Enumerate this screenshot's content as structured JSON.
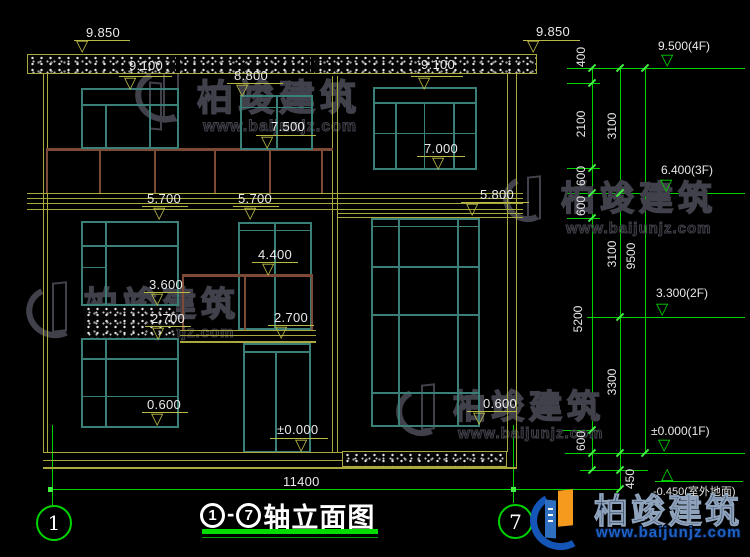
{
  "title": {
    "start": "1",
    "dash": "-",
    "end": "7",
    "text": "轴立面图"
  },
  "axes": {
    "left": "1",
    "right": "7"
  },
  "levels": {
    "a9850_l": "9.850",
    "a9850_r": "9.850",
    "a9100_l": "9.100",
    "a9100_r": "9.100",
    "a8800": "8.800",
    "a7500": "7.500",
    "a7000": "7.000",
    "a5700_l": "5.700",
    "a5700_r": "5.700",
    "a5800": "5.800",
    "a4400": "4.400",
    "a3600": "3.600",
    "a2700_l": "2.700",
    "a2700_r": "2.700",
    "a0600_l": "0.600",
    "a0600_r": "0.600",
    "a0000": "±0.000"
  },
  "floors": {
    "f4": "9.500(4F)",
    "f3": "6.400(3F)",
    "f2": "3.300(2F)",
    "f1": "±0.000(1F)",
    "outdoor": "-0.450(室外地面)"
  },
  "vdims": {
    "seg400": "400",
    "seg2100": "2100",
    "seg600a": "600",
    "seg600b": "600",
    "seg5200": "5200",
    "seg600c": "600",
    "seg450": "450",
    "seg3100a": "3100",
    "seg3100b": "3100",
    "seg3300": "3300",
    "total9500": "9500"
  },
  "hdims": {
    "total": "11400"
  },
  "watermark": {
    "brand": "柏竣建筑",
    "url": "www.baijunjz.com"
  },
  "logo": {
    "brand": "柏竣建筑",
    "url": "www.baijunjz.com"
  },
  "symbols": {
    "tri_down": "▽",
    "tri_up": "△"
  },
  "colors": {
    "background": "#000000",
    "line_yellow": "#a9a93d",
    "dim_yellow": "#b9b945",
    "line_green": "#00d400",
    "window_teal": "#3b8078",
    "railing_brown": "#7d4a38",
    "text": "#e9e9e9",
    "title_underline": "#00dd00",
    "logo_blue": "#1456b8",
    "logo_orange": "#f59a1d"
  }
}
